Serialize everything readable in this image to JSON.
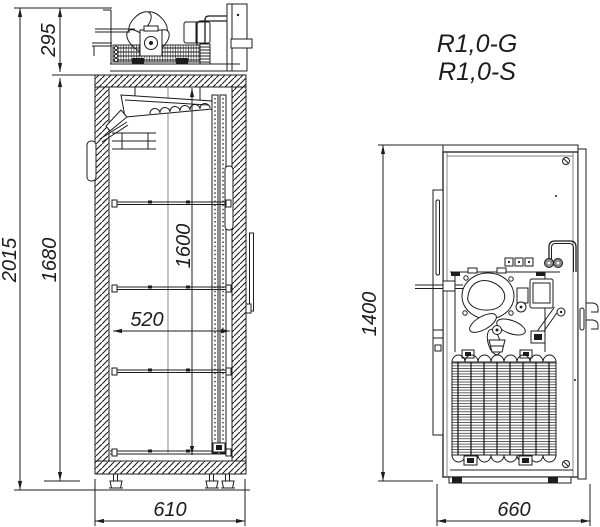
{
  "drawing": {
    "models": {
      "variant_g": "R1,0-G",
      "variant_s": "R1,0-S"
    },
    "side_view": {
      "dim_overall_height": "2015",
      "dim_machinery_height": "295",
      "dim_body_height": "1680",
      "dim_interior_height": "1600",
      "dim_shelf_depth": "520",
      "dim_overall_depth": "610"
    },
    "rear_view": {
      "dim_unit_height": "1400",
      "dim_overall_width": "660"
    },
    "colors": {
      "line": "#1c1c1c",
      "background": "#ffffff"
    }
  }
}
